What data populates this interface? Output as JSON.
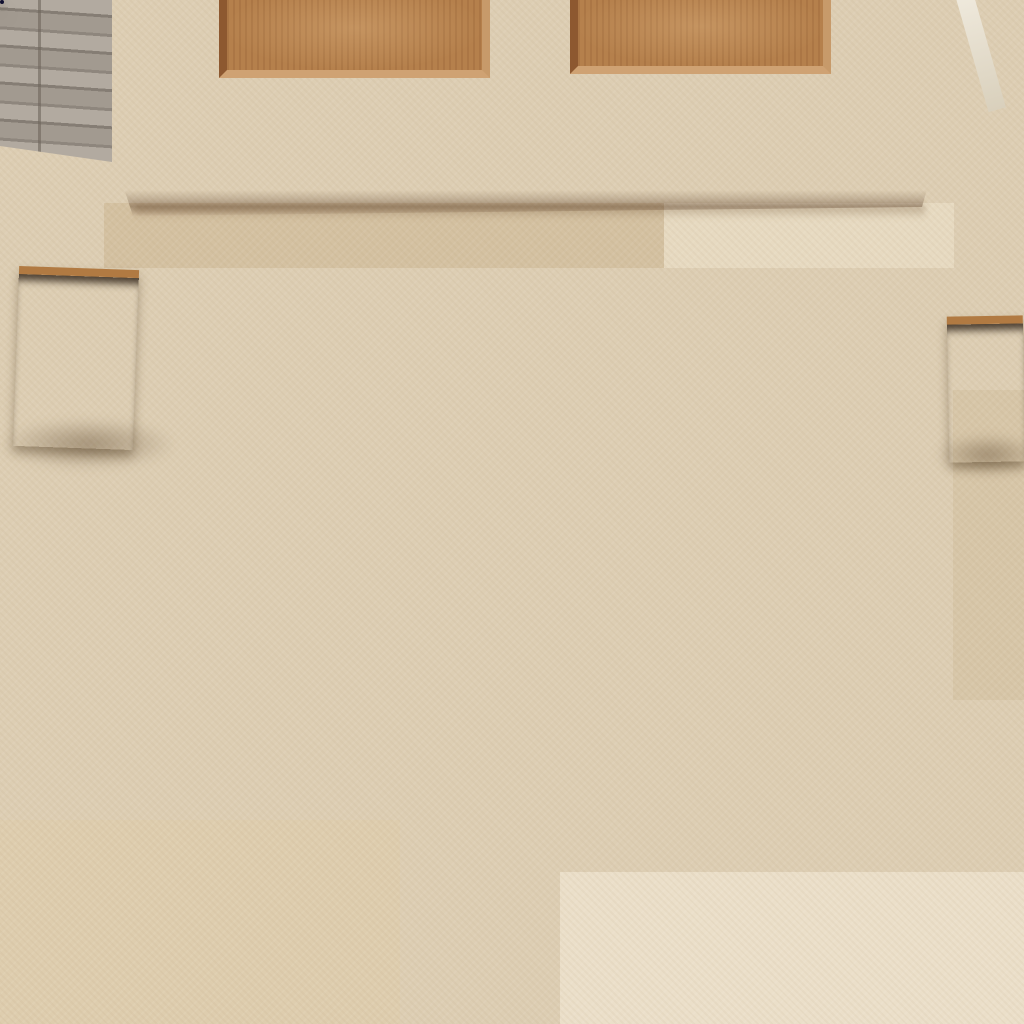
{
  "labels": {
    "scene": "Front entrance with wooden door, stone floor, two potted plants and a Polynesian doormat",
    "door": "Oak wood panel front door",
    "wall": "Grey stacked stone wall",
    "floor": "Beige travertine tile floor",
    "plant_left": "Potted green plant in wooden planter",
    "plant_right": "Potted green plant in wooden planter",
    "planter": "Wooden planter box",
    "mat": "Navy blue Polynesian tapa patchwork rubber doormat",
    "patchwork": "Tapa cloth patchwork panel with Samoan and Fijian motifs",
    "medallion": "Circular Samoan tapa medallion with braided rings and four tapa-filled petals",
    "swirl": "Lavender tribal swirl hook motif",
    "navy_field": "Deep navy field with tonal Polynesian tattoo pattern"
  },
  "palette": {
    "floor": "#ddceb3",
    "floor_light": "#eaddc5",
    "grout": "#c6b698",
    "wall": "#a9a198",
    "wall_dark": "#867e75",
    "door_wood": "#b17c4a",
    "door_wood_dark": "#8a5830",
    "door_wood_deep": "#6f431f",
    "rail_light": "#c09059",
    "planter": "#96622f",
    "plant_dark": "#2e5222",
    "plant_mid": "#3f6b2e",
    "plant_light": "#55833a",
    "mat_navy": "#2b2b74",
    "mat_navy_dark": "#1e1e56",
    "mat_black": "#0c0c1e",
    "mat_teal": "#2aa3c9",
    "mat_purple": "#423c96",
    "mat_lavender": "#a8a4d8",
    "mat_silver": "#cfcfe2",
    "mat_white": "#ececf4",
    "mat_ring_dark": "#20203f"
  },
  "mat": {
    "position": {
      "left": 104,
      "top": 268,
      "width": 849,
      "height": 552,
      "rotation_deg": -0.35
    },
    "medallion": {
      "cx": 321,
      "cy": 157,
      "r": 138,
      "petal_offset": 40
    },
    "sphere": {
      "cx": 408,
      "cy": 318,
      "r": 56
    },
    "swirl": {
      "hook": {
        "cx": 421,
        "cy": 292,
        "r": 56
      },
      "band1": {
        "x": 398,
        "y": 262,
        "w": 44,
        "h": 310,
        "rot": -17
      },
      "band2": {
        "x": 378,
        "y": 300,
        "w": 20,
        "h": 270,
        "rot": -13
      }
    },
    "patchwork_tiles": [
      {
        "x": 0,
        "y": 0,
        "w": 176,
        "h": 27,
        "m": "arch",
        "bg": "#10102a",
        "fg": "#5a4fa6",
        "ac": "#e9e9f2"
      },
      {
        "x": 176,
        "y": 0,
        "w": 50,
        "h": 27,
        "m": "tri",
        "bg": "#b0acdc",
        "fg": "#2a2866",
        "ac": "#ffffff"
      },
      {
        "x": 226,
        "y": 0,
        "w": 125,
        "h": 22,
        "m": "smallband",
        "bg": "#9b97cc",
        "fg": "#23215e",
        "ac": "#e9e9f2"
      },
      {
        "x": 0,
        "y": 27,
        "w": 101,
        "h": 37,
        "m": "leafquad",
        "bg": "#0b0b1a",
        "fg": "#2aa3c9",
        "ac": "#d8f2fa"
      },
      {
        "x": 101,
        "y": 27,
        "w": 75,
        "h": 186,
        "m": "dstrip",
        "bg": "#423c96",
        "fg": "#e9e9f2",
        "ac": "#141432"
      },
      {
        "x": 0,
        "y": 64,
        "w": 101,
        "h": 88,
        "m": "flower8",
        "bg": "#0b0b1a",
        "fg": "#2aa3c9",
        "ac": "#e9e9f2"
      },
      {
        "x": 176,
        "y": 27,
        "w": 50,
        "h": 83,
        "m": "lavtiles",
        "bg": "#9b97cc",
        "fg": "#23215e",
        "ac": "#e9e9f2"
      },
      {
        "x": 176,
        "y": 110,
        "w": 50,
        "h": 112,
        "m": "leaflattice",
        "bg": "#1d1b4e",
        "fg": "#cfcfe2",
        "ac": "#2aa3c9"
      },
      {
        "x": 0,
        "y": 152,
        "w": 101,
        "h": 84,
        "m": "lattice",
        "bg": "#ececf4",
        "fg": "#34308a",
        "ac": "#141432"
      },
      {
        "x": 0,
        "y": 236,
        "w": 101,
        "h": 44,
        "m": "xdrow",
        "bg": "#23215e",
        "fg": "#e9e9f2",
        "ac": "#2aa3c9"
      },
      {
        "x": 101,
        "y": 213,
        "w": 112,
        "h": 67,
        "m": "frond",
        "bg": "#242165",
        "fg": "#ececf4",
        "ac": "#a8a4d8"
      },
      {
        "x": 0,
        "y": 280,
        "w": 101,
        "h": 17,
        "m": "band3e",
        "bg": "#0c0c1e",
        "fg": "#e9e9f2",
        "ac": "#a8a4d8"
      },
      {
        "x": 0,
        "y": 297,
        "w": 101,
        "h": 20,
        "m": "xband",
        "bg": "#23215e",
        "fg": "#e9e9f2",
        "ac": "#2aa3c9"
      },
      {
        "x": 0,
        "y": 317,
        "w": 101,
        "h": 60,
        "m": "wheat",
        "bg": "#2a2870",
        "fg": "#dcdcea",
        "ac": "#a8a4d8"
      },
      {
        "x": 101,
        "y": 280,
        "w": 105,
        "h": 95,
        "m": "starburst",
        "bg": "#0b0b1a",
        "fg": "#ececf4",
        "ac": "#2aa3c9"
      },
      {
        "x": 106,
        "y": 375,
        "w": 100,
        "h": 19,
        "m": "braid",
        "bg": "#23215e",
        "fg": "#cfcfe2",
        "ac": "#141432"
      },
      {
        "x": 0,
        "y": 377,
        "w": 99,
        "h": 70,
        "m": "tealsq",
        "bg": "#2aa3c9",
        "fg": "#0a2836",
        "ac": "#e9f6fb"
      },
      {
        "x": 106,
        "y": 394,
        "w": 100,
        "h": 53,
        "m": "dpetal",
        "bg": "#262368",
        "fg": "#e9e9f2",
        "ac": "#2aa3c9"
      },
      {
        "x": 0,
        "y": 449,
        "w": 99,
        "h": 103,
        "m": "pinwheel",
        "bg": "#ececf4",
        "fg": "#2b2a72",
        "ac": "#141432"
      },
      {
        "x": 99,
        "y": 449,
        "w": 246,
        "h": 23,
        "m": "band3e",
        "bg": "#17173a",
        "fg": "#e9e9f2",
        "ac": "#2aa3c9"
      },
      {
        "x": 99,
        "y": 472,
        "w": 110,
        "h": 20,
        "m": "zigzag",
        "bg": "#23215e",
        "fg": "#e9e9f2",
        "ac": "#2aa3c9"
      },
      {
        "x": 209,
        "y": 472,
        "w": 54,
        "h": 42,
        "m": "hatch",
        "bg": "#262368",
        "fg": "#a8a4d8",
        "ac": "#141432"
      },
      {
        "x": 99,
        "y": 492,
        "w": 110,
        "h": 60,
        "m": "bowtie",
        "bg": "#ececf4",
        "fg": "#23215e",
        "ac": "#2aa3c9"
      },
      {
        "x": 210,
        "y": 272,
        "w": 120,
        "h": 40,
        "m": "ferns",
        "bg": "#2b2870",
        "fg": "#e9e9f2",
        "ac": "#2aa3c9"
      },
      {
        "x": 229,
        "y": 312,
        "w": 91,
        "h": 27,
        "m": "dband",
        "bg": "#141432",
        "fg": "#2aa3c9",
        "ac": "#e9e9f2"
      },
      {
        "x": 211,
        "y": 347,
        "w": 119,
        "h": 43,
        "m": "quadflower",
        "bg": "#ececf4",
        "fg": "#262368",
        "ac": "#2aa3c9"
      },
      {
        "x": 243,
        "y": 394,
        "w": 47,
        "h": 55,
        "m": "hatch",
        "bg": "#34308a",
        "fg": "#e9e9f2",
        "ac": "#141432"
      },
      {
        "x": 293,
        "y": 410,
        "w": 87,
        "h": 17,
        "m": "braid",
        "bg": "#17173a",
        "fg": "#cfcfe2",
        "ac": "#141432"
      },
      {
        "x": 296,
        "y": 429,
        "w": 60,
        "h": 20,
        "m": "arrows",
        "bg": "#ececf4",
        "fg": "#17173a",
        "ac": "#141432"
      },
      {
        "x": 263,
        "y": 469,
        "w": 87,
        "h": 45,
        "m": "uuu",
        "bg": "#23215e",
        "fg": "#ececf4",
        "ac": "#2aa3c9"
      },
      {
        "x": 209,
        "y": 514,
        "w": 141,
        "h": 38,
        "m": "smallband",
        "bg": "#2b2870",
        "fg": "#e9e9f2",
        "ac": "#2aa3c9"
      },
      {
        "x": 209,
        "y": 292,
        "w": 20,
        "h": 55,
        "m": "vstripe",
        "bg": "#2aa3c9",
        "fg": "#0a2836",
        "ac": "#e9f6fb"
      },
      {
        "x": 316,
        "y": 285,
        "w": 71,
        "h": 100,
        "m": "cross",
        "bg": "#3a3588",
        "fg": "#e9e9f2",
        "ac": "#141432"
      },
      {
        "x": 391,
        "y": 300,
        "w": 26,
        "h": 100,
        "m": "dstrip",
        "bg": "#33306f",
        "fg": "#cfcfe2",
        "ac": "#141432"
      },
      {
        "x": 406,
        "y": 342,
        "w": 50,
        "h": 70,
        "m": "quadflower",
        "bg": "#3a3588",
        "fg": "#ececf4",
        "ac": "#2aa3c9"
      }
    ]
  }
}
